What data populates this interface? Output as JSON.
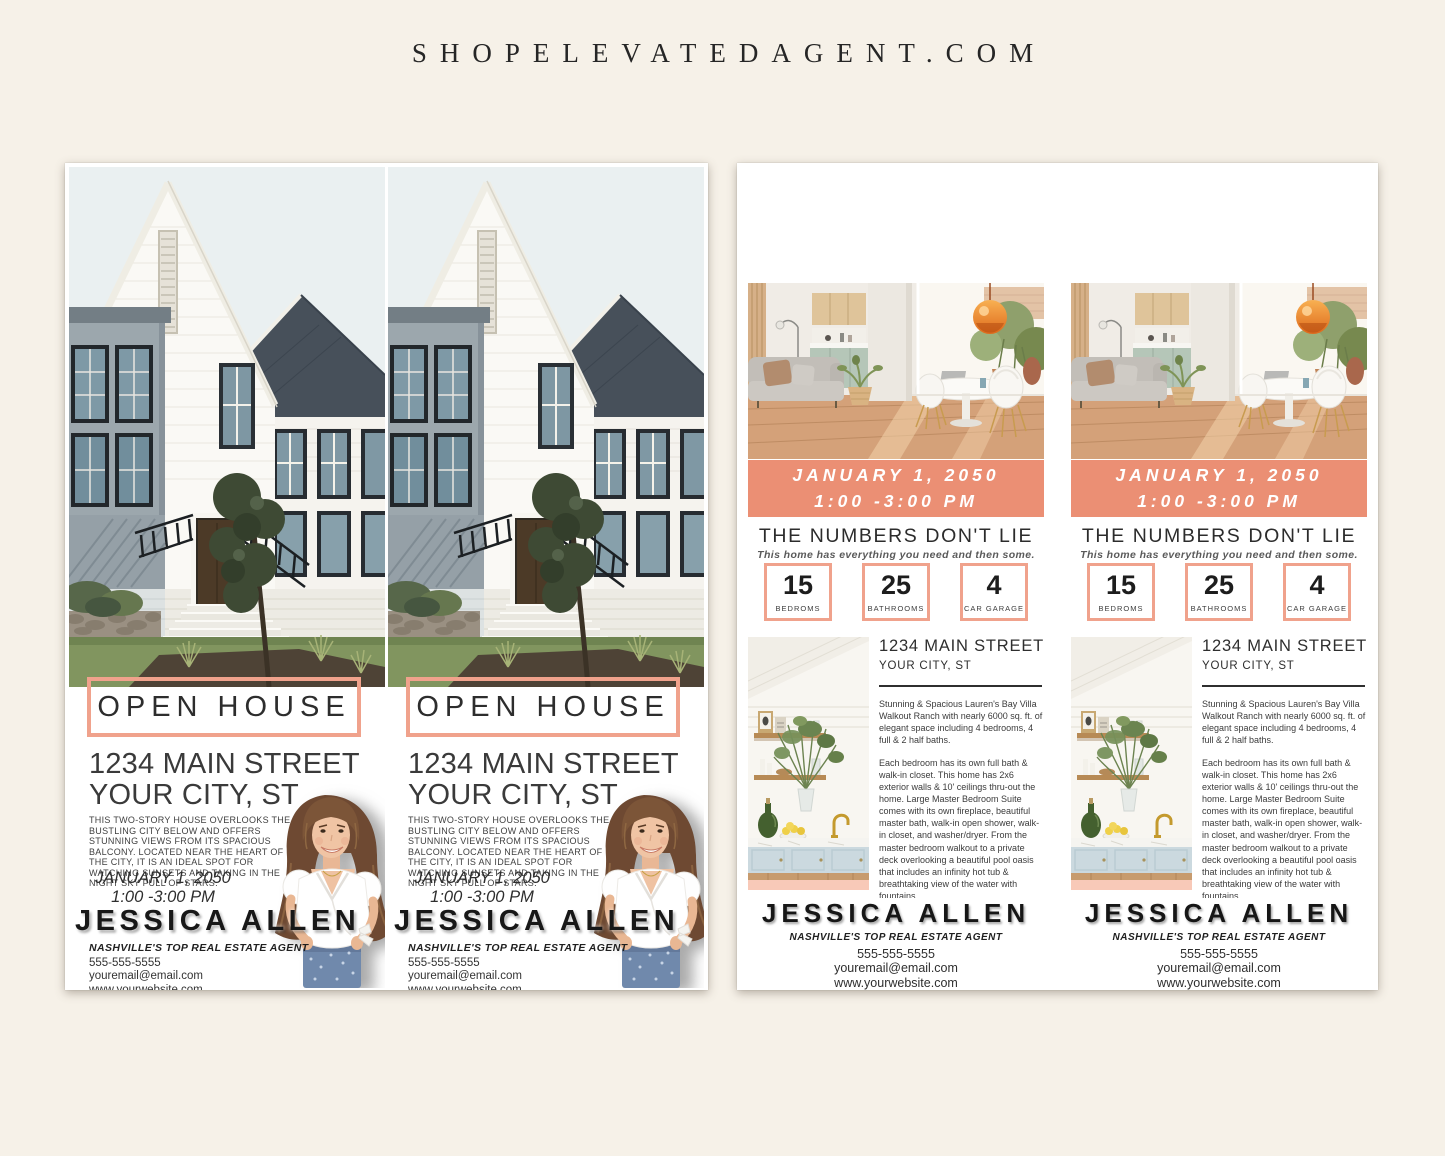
{
  "header": {
    "site_name": "SHOPELEVATEDAGENT.COM"
  },
  "colors": {
    "coral_banner": "#EB8F74",
    "coral_border": "#F0A28C",
    "cream_background": "#F6F1E8",
    "peach_strip": "#F8C9B8"
  },
  "front_flyer": {
    "open_house_label": "OPEN HOUSE",
    "address_line1": "1234 MAIN STREET",
    "address_line2": "YOUR CITY, ST",
    "description": "THIS TWO-STORY HOUSE OVERLOOKS THE BUSTLING CITY BELOW AND OFFERS STUNNING VIEWS FROM ITS SPACIOUS BALCONY. LOCATED NEAR THE HEART OF THE CITY, IT IS AN IDEAL SPOT FOR WATCHING SUNSETS AND TAKING IN THE NIGHT SKY FULL OF STARS.",
    "date_line1": "JANUARY 1, 2050",
    "date_line2": "1:00 -3:00 PM",
    "agent_name": "JESSICA ALLEN",
    "agent_title": "NASHVILLE'S TOP REAL ESTATE AGENT",
    "phone": "555-555-5555",
    "email": "youremail@email.com",
    "website": "www.yourwebsite.com"
  },
  "back_flyer": {
    "date_line1": "JANUARY 1, 2050",
    "date_line2": "1:00 -3:00 PM",
    "headline": "THE NUMBERS DON'T LIE",
    "subheadline": "This home has everything you need and then some.",
    "stats": [
      {
        "value": "15",
        "label": "BEDROMS"
      },
      {
        "value": "25",
        "label": "BATHROOMS"
      },
      {
        "value": "4",
        "label": "CAR GARAGE"
      }
    ],
    "address_line1": "1234 MAIN STREET",
    "address_line2": "YOUR CITY, ST",
    "paragraph1": "Stunning & Spacious Lauren's Bay Villa Walkout Ranch with nearly 6000 sq. ft. of elegant space including 4 bedrooms, 4 full & 2 half baths.",
    "paragraph2": "Each bedroom has its own full bath & walk-in closet. This home has 2x6 exterior walls & 10' ceilings thru-out the home. Large Master Bedroom Suite comes with its own fireplace, beautiful master bath, walk-in open shower, walk-in closet, and washer/dryer. From the master bedroom walkout to a private deck overlooking a beautiful pool oasis that includes an infinity hot tub & breathtaking view of the water with fountains.",
    "agent_name": "JESSICA ALLEN",
    "agent_title": "NASHVILLE'S TOP REAL ESTATE AGENT",
    "phone": "555-555-5555",
    "email": "youremail@email.com",
    "website": "www.yourwebsite.com"
  }
}
